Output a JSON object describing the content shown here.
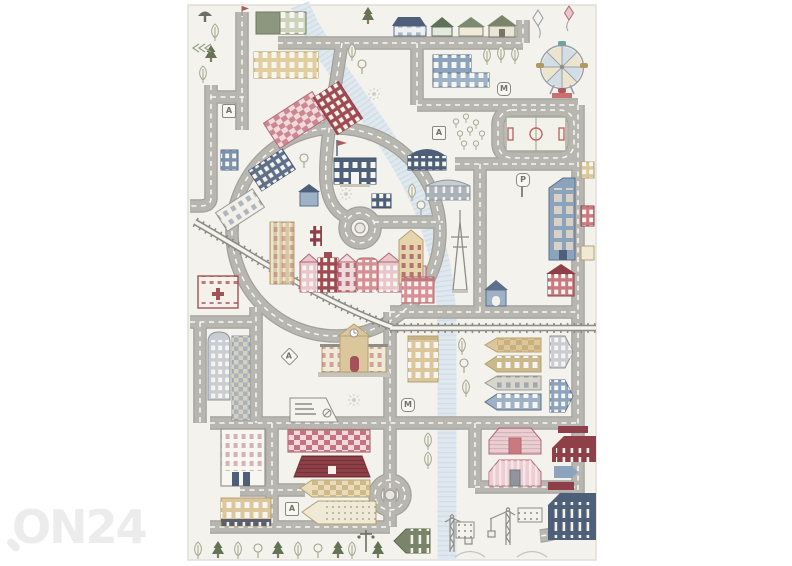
{
  "watermark": {
    "text": "ON24",
    "color": "#ececec"
  },
  "rug": {
    "signs": [
      {
        "label": "A"
      },
      {
        "label": "M"
      },
      {
        "label": "A"
      },
      {
        "label": "P"
      },
      {
        "label": "A"
      },
      {
        "label": "M"
      },
      {
        "label": "A"
      }
    ],
    "colors": {
      "background": "#ffffff",
      "base": "#f3f2ec",
      "road": "#b8b6b0",
      "road_casing": "#a3a19a",
      "road_dash": "#f8f7f3",
      "river": "#dfe8ee",
      "river_stripe": "#c3d3e0",
      "railway": "#8d8b83",
      "navy": "#4e5f7a",
      "blue": "#8ba3bd",
      "powder_blue": "#9db1c7",
      "pink": "#e8c6ca",
      "rose": "#d98f96",
      "maroon": "#9e4a50",
      "dark_maroon": "#8e3f47",
      "tan": "#dcc79c",
      "tan_dark": "#b3a173",
      "cream": "#f0e9d4",
      "sage": "#97a08b",
      "pine_green": "#657456",
      "olive": "#7a8468",
      "gray": "#c9ccd2",
      "outline": "#8f8d86"
    }
  }
}
